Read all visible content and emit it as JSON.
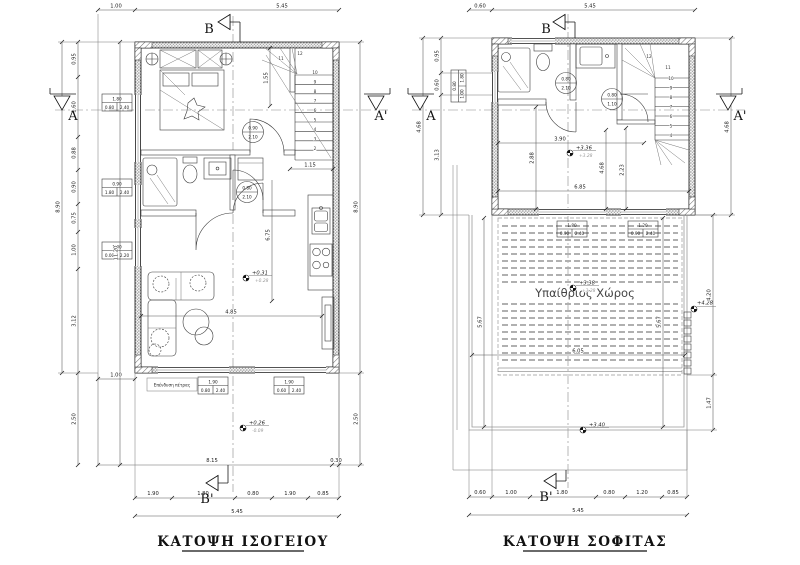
{
  "ground_plan": {
    "title": "ΚΑΤΟΨΗ ΙΣΟΓΕΙΟΥ",
    "stone_label": "Επένδυση πέτρας",
    "section_markers": {
      "top": "B",
      "bottom": "B'",
      "left": "A",
      "right": "A'"
    },
    "levels": {
      "floor": "+0.31",
      "floor_sub": "+0.28",
      "terrace": "+0.26",
      "terrace_sub": "-0.09"
    },
    "dims": {
      "top_offset": "1.00",
      "top_total": "5.45",
      "left_overall": "8.90",
      "left_chain": [
        "0.95",
        "1.60",
        "0.88",
        "0.90",
        "0.75",
        "1.00",
        "3.12"
      ],
      "left_terrace": "2.50",
      "left_with_terrace": "11.20",
      "terrace_offset": "1.00",
      "right_overall": "8.90",
      "right_terrace": "2.50",
      "stair_width": "1.55",
      "stair_landing": "1.15",
      "hall_length": "6.75",
      "living_width": "4.85",
      "terrace_width": "8.15",
      "wall_edge": "0.30",
      "bottom_chain": [
        "1.90",
        "1.80",
        "0.80",
        "1.90",
        "0.85"
      ],
      "bottom_total": "5.45"
    },
    "window_tags": [
      {
        "w": "1.80",
        "sill": "0.80",
        "head": "2.40"
      },
      {
        "w": "0.90",
        "sill": "1.80",
        "head": "2.40"
      },
      {
        "w": "1.00",
        "sill": "0.00",
        "head": "2.20"
      },
      {
        "w": "1.90",
        "sill": "0.80",
        "head": "2.40"
      },
      {
        "w": "1.90",
        "sill": "0.60",
        "head": "2.40"
      }
    ],
    "door_tags": [
      {
        "w": "0.90",
        "h": "2.10"
      },
      {
        "w": "0.80",
        "h": "2.10"
      }
    ],
    "stair_numbers": [
      "2",
      "3",
      "4",
      "5",
      "6",
      "7",
      "8",
      "9",
      "10"
    ],
    "stair_numbers_upper": [
      "11",
      "12"
    ]
  },
  "attic_plan": {
    "title": "ΚΑΤΟΨΗ ΣΟΦΙΤΑΣ",
    "room_label": "Υπαίθριος Χώρος",
    "section_markers": {
      "top": "B",
      "bottom": "B'",
      "left": "A",
      "right": "A'"
    },
    "levels": {
      "floor": "+3.36",
      "floor_sub": "+3.28",
      "terrace": "+3.38",
      "terrace_sub": "+3.28",
      "terrace_edge": "+3.40",
      "stair_top": "+4.28"
    },
    "dims": {
      "top_offset": "0.60",
      "top_total": "5.45",
      "left_overall": "4.68",
      "left_chain": [
        "0.95",
        "0.60",
        "3.13"
      ],
      "right_overall": "4.68",
      "room_width": "3.90",
      "room_depth": "4.68",
      "room_full_width": "6.85",
      "left_depth": "2.88",
      "stair_depth": "2.23",
      "terrace_left": "5.67",
      "terrace_right": "5.67",
      "terrace_width": "6.05",
      "right_chain": [
        "4.20",
        "1.47"
      ],
      "bottom_chain": [
        "0.60",
        "1.00",
        "1.80",
        "0.80",
        "1.20",
        "0.85"
      ],
      "bottom_total": "5.45"
    },
    "window_tags": [
      {
        "w": "0.80",
        "sill": "1.00",
        "head": "1.80"
      },
      {
        "w": "1.80",
        "sill": "0.90",
        "head": "2.40"
      },
      {
        "w": "1.20",
        "sill": "0.90",
        "head": "2.40"
      }
    ],
    "door_tags": [
      {
        "w": "0.80",
        "h": "2.10"
      },
      {
        "w": "0.80",
        "h": "1.10"
      }
    ],
    "stair_numbers": [
      "4",
      "5",
      "6",
      "7",
      "8",
      "9",
      "10",
      "11"
    ],
    "stair_numbers_upper": [
      "12"
    ]
  }
}
